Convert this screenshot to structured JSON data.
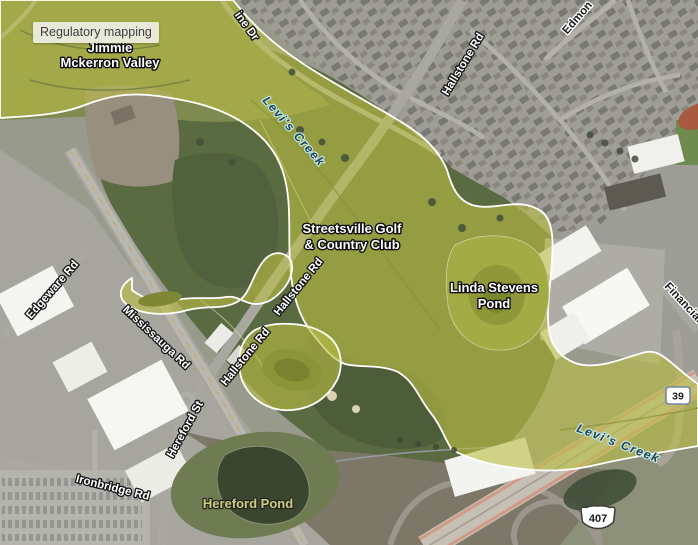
{
  "tooltip": {
    "label": "Regulatory mapping"
  },
  "places": {
    "valley": {
      "line1": "Jimmie",
      "line2": "Mckerron Valley"
    },
    "golf_club": {
      "line1": "Streetsville Golf",
      "line2": "& Country Club"
    },
    "linda_pond": {
      "line1": "Linda Stevens",
      "line2": "Pond"
    },
    "hereford_pond": {
      "label": "Hereford Pond"
    }
  },
  "waterways": {
    "levis_creek": {
      "label": "Levi's Creek"
    }
  },
  "roads": {
    "hallstone": {
      "label": "Hallstone Rd"
    },
    "mississauga": {
      "label": "Mississauga Rd"
    },
    "edgeware": {
      "label": "Edgeware Rd"
    },
    "hereford": {
      "label": "Hereford St"
    },
    "ironbridge": {
      "label": "Ironbridge Rd"
    },
    "financial": {
      "label": "Financial"
    },
    "edmon_fragment": {
      "label": "Edmon"
    },
    "ine_dr_fragment": {
      "label": "ine Dr"
    }
  },
  "route_shields": {
    "regional_39": {
      "number": "39"
    },
    "highway_407": {
      "number": "407"
    }
  },
  "colors": {
    "regulatory_overlay": "#b9bd45",
    "overlay_boundary": "#ffffff",
    "creek_label": "#1c4653",
    "pond_label": "#c9cd82",
    "tooltip_bg": "#eeefe6",
    "tooltip_text": "#3d3d3d",
    "shield_39_border": "#7286a8",
    "highway_edge": "#d29a86"
  }
}
